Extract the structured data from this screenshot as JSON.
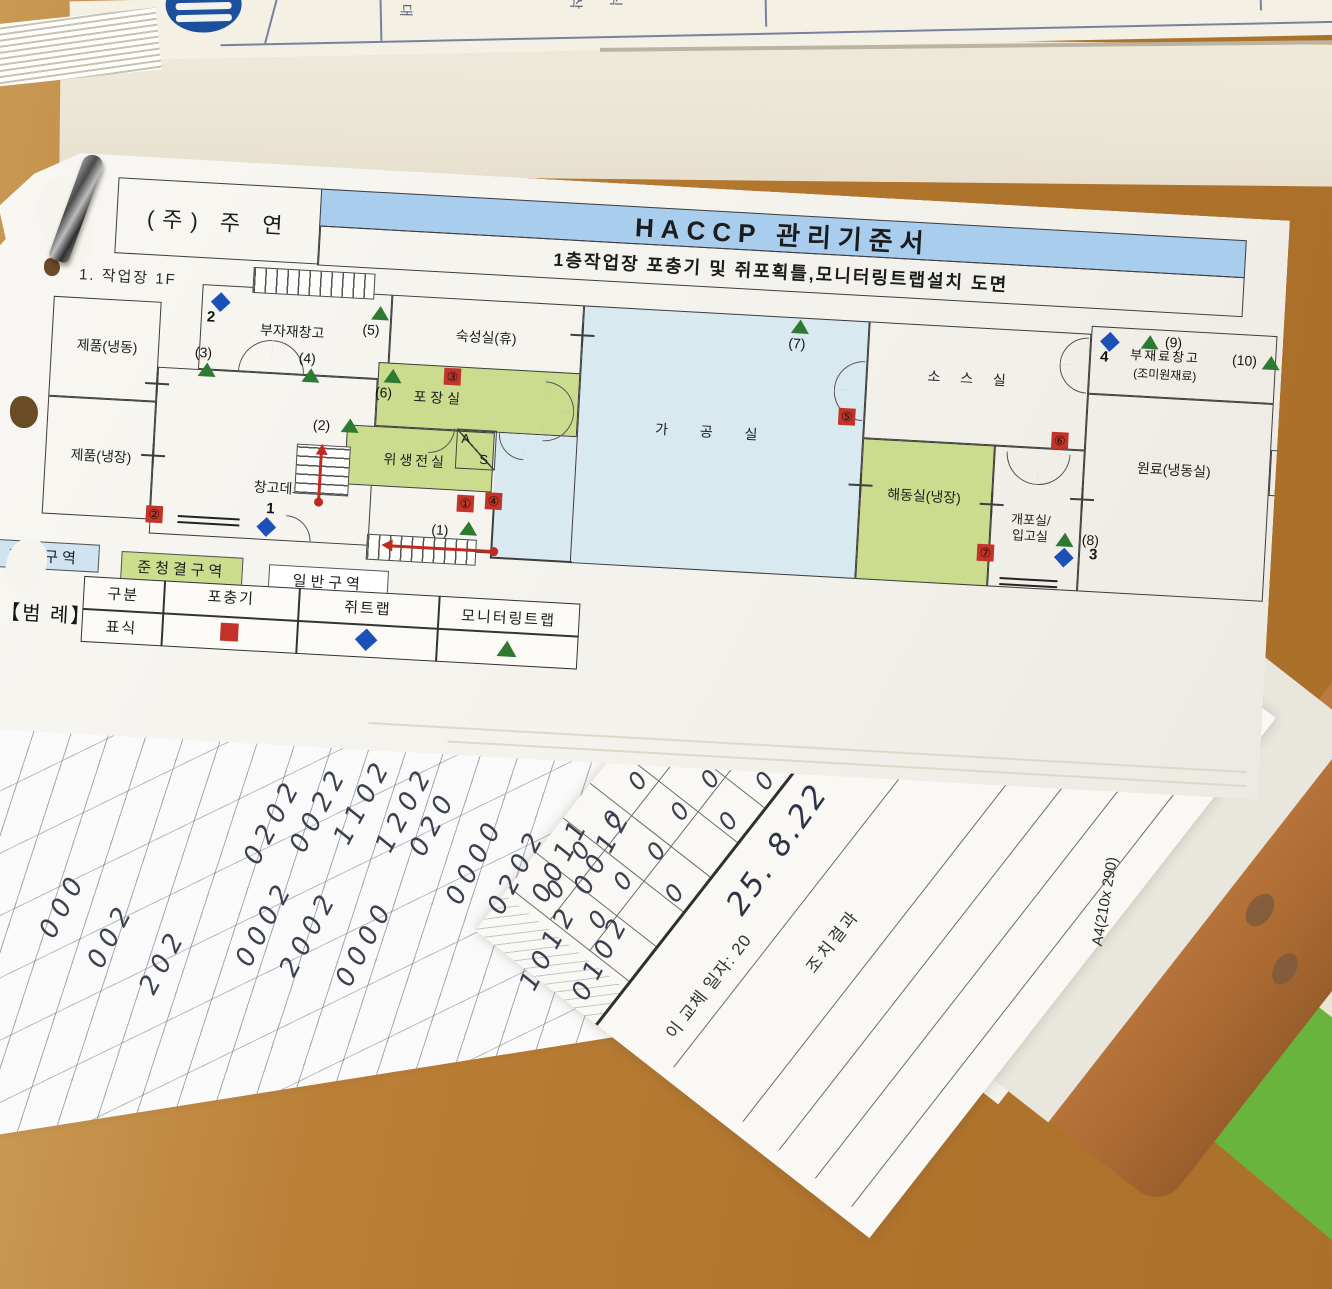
{
  "document": {
    "company": "(주) 주 연",
    "title": "HACCP 관리기준서",
    "subtitle": "1층작업장 포충기 및 쥐포획틀,모니터링트랩설치 도면",
    "page_label": "1. 작업장 1F"
  },
  "colors": {
    "title_band": "#a9cdec",
    "zone_clean": "#cfe4f0",
    "zone_semi_clean": "#ccdd8e",
    "room_green": "#ccdc8f",
    "room_blue": "#d9e9f0",
    "trap_red": "#c2342a",
    "trap_blue": "#1b50b8",
    "trap_green": "#2f7a33",
    "wood": "#b0742c",
    "mat_green": "#69b43c",
    "clipboard_brown": "#ad6c33"
  },
  "top_sheet": {
    "chars": [
      {
        "t": "대",
        "x": 330,
        "y": 6
      },
      {
        "t": "삭",
        "x": 500,
        "y": 2
      },
      {
        "t": "식",
        "x": 540,
        "y": 0
      },
      {
        "t": "구",
        "x": 848,
        "y": 0
      }
    ]
  },
  "plan": {
    "rooms": [
      {
        "id": "jepum-naengdong",
        "label": "제품(냉동)",
        "x": 2,
        "y": 140,
        "w": 108,
        "h": 100,
        "lx": 58,
        "ly": 188
      },
      {
        "id": "jepum-naengjang",
        "label": "제품(냉장)",
        "x": 2,
        "y": 240,
        "w": 108,
        "h": 118,
        "lx": 58,
        "ly": 298
      },
      {
        "id": "bujajae-changgo",
        "label": "부자재창고",
        "x": 150,
        "y": 120,
        "w": 190,
        "h": 85,
        "lx": 242,
        "ly": 163
      },
      {
        "id": "changgo-deck",
        "label": "창고데크",
        "x": 110,
        "y": 205,
        "w": 220,
        "h": 167,
        "lx": 238,
        "ly": 320
      },
      {
        "id": "sukseongsil",
        "label": "숙성실(휴)",
        "x": 340,
        "y": 120,
        "w": 192,
        "h": 85,
        "lx": 436,
        "ly": 158
      },
      {
        "id": "pojangsil",
        "label": "포장실",
        "x": 330,
        "y": 188,
        "w": 202,
        "h": 64,
        "fill": "#ccdc8f",
        "lx": 392,
        "ly": 221,
        "ls": 4
      },
      {
        "id": "wisaeng-jeonsil",
        "label": "위생전실",
        "x": 302,
        "y": 252,
        "w": 148,
        "h": 60,
        "fill": "#ccdc8f",
        "lx": 372,
        "ly": 285,
        "ls": 3
      },
      {
        "id": "gagongsil-patch",
        "label": "",
        "x": 452,
        "y": 252,
        "w": 82,
        "h": 126,
        "fill": "#d9e9f0",
        "nb": true
      },
      {
        "id": "gagongsil",
        "label": "가 공 실",
        "x": 532,
        "y": 120,
        "w": 286,
        "h": 258,
        "fill": "#d9e9f0",
        "lx": 668,
        "ly": 240,
        "ls": 14
      },
      {
        "id": "soseusil",
        "label": "소 스 실",
        "x": 818,
        "y": 120,
        "w": 222,
        "h": 117,
        "lx": 922,
        "ly": 172,
        "ls": 8
      },
      {
        "id": "haedongsil",
        "label": "해동실(냉장)",
        "x": 818,
        "y": 237,
        "w": 132,
        "h": 141,
        "fill": "#ccdc8f",
        "lx": 882,
        "ly": 292
      },
      {
        "id": "gaeposil",
        "label": "개포실/\n입고실",
        "x": 950,
        "y": 237,
        "w": 90,
        "h": 141,
        "lx": 990,
        "ly": 318,
        "fs": 13
      },
      {
        "id": "bujaeryo-changgo",
        "label": "",
        "x": 1040,
        "y": 112,
        "w": 186,
        "h": 68
      },
      {
        "id": "wonryo",
        "label": "원료(냉동실)",
        "x": 1040,
        "y": 180,
        "w": 186,
        "h": 198,
        "lx": 1130,
        "ly": 252
      },
      {
        "id": "chwisujeong",
        "label": "취수정",
        "x": 1226,
        "y": 226,
        "w": 44,
        "h": 46,
        "lx": 1248,
        "ly": 249,
        "vert": true,
        "fs": 11
      }
    ],
    "free_labels": [
      {
        "t": "부재료창고",
        "x": 1080,
        "y": 128,
        "fs": 13,
        "ls": 2
      },
      {
        "t": "(조미원재료)",
        "x": 1084,
        "y": 148,
        "fs": 12
      }
    ],
    "walls": [
      {
        "x": 330,
        "y": 371,
        "len": 124,
        "o": "h"
      },
      {
        "x": 452,
        "y": 376,
        "len": 82,
        "o": "h"
      },
      {
        "x": 452,
        "y": 312,
        "len": 66,
        "o": "v"
      }
    ],
    "stairs": [
      {
        "x": 200,
        "y": 100,
        "w": 122,
        "h": 26,
        "dir": "v"
      },
      {
        "x": 253,
        "y": 274,
        "w": 54,
        "h": 50,
        "dir": "h"
      },
      {
        "x": 328,
        "y": 360,
        "w": 110,
        "h": 26,
        "dir": "v"
      }
    ],
    "docks": [
      {
        "x": 138,
        "y": 352,
        "w": 62
      },
      {
        "x": 962,
        "y": 368,
        "w": 58
      }
    ],
    "doors": [
      {
        "x": 190,
        "y": 172,
        "r": 33,
        "c": "tl"
      },
      {
        "x": 223,
        "y": 172,
        "r": 33,
        "c": "tr"
      },
      {
        "x": 498,
        "y": 198,
        "r": 30,
        "c": "tr"
      },
      {
        "x": 498,
        "y": 228,
        "r": 30,
        "c": "br"
      },
      {
        "x": 786,
        "y": 160,
        "r": 30,
        "c": "tl"
      },
      {
        "x": 786,
        "y": 190,
        "r": 30,
        "c": "bl"
      },
      {
        "x": 384,
        "y": 250,
        "r": 26,
        "c": "br"
      },
      {
        "x": 454,
        "y": 252,
        "r": 26,
        "c": "bl"
      },
      {
        "x": 246,
        "y": 346,
        "r": 26,
        "c": "tr"
      },
      {
        "x": 962,
        "y": 242,
        "r": 32,
        "c": "bl"
      },
      {
        "x": 994,
        "y": 242,
        "r": 32,
        "c": "br"
      },
      {
        "x": 1010,
        "y": 124,
        "r": 28,
        "c": "tl"
      },
      {
        "x": 1010,
        "y": 152,
        "r": 28,
        "c": "bl"
      }
    ],
    "crosses": [
      {
        "x": 110,
        "y": 222
      },
      {
        "x": 110,
        "y": 294
      },
      {
        "x": 532,
        "y": 150
      },
      {
        "x": 818,
        "y": 284
      },
      {
        "x": 950,
        "y": 296
      },
      {
        "x": 1040,
        "y": 286
      }
    ],
    "arrows": [
      {
        "x1": 278,
        "y1": 332,
        "x2": 278,
        "y2": 282
      },
      {
        "x1": 456,
        "y1": 371,
        "x2": 352,
        "y2": 371
      }
    ],
    "insect_traps": [
      {
        "sym": "①",
        "x": 416,
        "y": 316
      },
      {
        "sym": "②",
        "x": 106,
        "y": 344
      },
      {
        "sym": "③",
        "x": 396,
        "y": 190
      },
      {
        "sym": "④",
        "x": 444,
        "y": 312
      },
      {
        "sym": "⑤",
        "x": 792,
        "y": 208
      },
      {
        "sym": "⑥",
        "x": 1006,
        "y": 220
      },
      {
        "sym": "⑦",
        "x": 938,
        "y": 336
      }
    ],
    "rat_traps": [
      {
        "n": "1",
        "x": 220,
        "y": 352,
        "lx": 226,
        "ly": 332
      },
      {
        "n": "2",
        "x": 162,
        "y": 130,
        "lx": 156,
        "ly": 144
      },
      {
        "n": "3",
        "x": 1018,
        "y": 338,
        "lx": 1050,
        "ly": 332
      },
      {
        "n": "4",
        "x": 1052,
        "y": 120,
        "lx": 1050,
        "ly": 134
      }
    ],
    "monitor_traps": [
      {
        "lab": "(1)",
        "x": 420,
        "y": 342,
        "lx": 392,
        "ly": 344
      },
      {
        "lab": "(2)",
        "x": 296,
        "y": 246,
        "lx": 268,
        "ly": 246
      },
      {
        "lab": "(3)",
        "x": 150,
        "y": 198,
        "lx": 146,
        "ly": 180
      },
      {
        "lab": "(4)",
        "x": 254,
        "y": 198,
        "lx": 250,
        "ly": 180
      },
      {
        "lab": "(5)",
        "x": 320,
        "y": 132,
        "lx": 312,
        "ly": 148
      },
      {
        "lab": "(6)",
        "x": 336,
        "y": 194,
        "lx": 328,
        "ly": 210
      },
      {
        "lab": "(7)",
        "x": 740,
        "y": 122,
        "lx": 738,
        "ly": 138
      },
      {
        "lab": "(8)",
        "x": 1016,
        "y": 320,
        "lx": 1042,
        "ly": 318
      },
      {
        "lab": "(9)",
        "x": 1090,
        "y": 118,
        "lx": 1114,
        "ly": 116
      },
      {
        "lab": "(10)",
        "x": 1212,
        "y": 132,
        "lx": 1182,
        "ly": 130
      }
    ],
    "as_box": {
      "x": 412,
      "y": 250,
      "w": 40,
      "h": 40,
      "a": "A",
      "s": "S"
    },
    "zones": [
      {
        "label": "청결구역",
        "x": -48,
        "y": 386,
        "w": 110,
        "h": 28,
        "fill": "#cfe4f0"
      },
      {
        "label": "준청결구역",
        "x": 84,
        "y": 391,
        "w": 122,
        "h": 28,
        "fill": "#ccdd8e"
      },
      {
        "label": "일반구역",
        "x": 232,
        "y": 396,
        "w": 120,
        "h": 28,
        "fill": "#ffffff"
      }
    ],
    "legend_title": "【범 례】",
    "legend": {
      "box": {
        "x": 48,
        "y": 418,
        "w": 497,
        "h": 66
      },
      "vlines": [
        128,
        263,
        403
      ],
      "hline_y": 450,
      "headers": [
        {
          "t": "구분",
          "x": 88,
          "y": 434
        },
        {
          "t": "포충기",
          "x": 196,
          "y": 431
        },
        {
          "t": "쥐트랩",
          "x": 333,
          "y": 434
        },
        {
          "t": "모니터링트랩",
          "x": 474,
          "y": 436
        }
      ],
      "row_label": {
        "t": "표식",
        "x": 88,
        "y": 467
      },
      "symbols": [
        {
          "k": "sq",
          "x": 196,
          "y": 466
        },
        {
          "k": "d",
          "x": 333,
          "y": 466
        },
        {
          "k": "t",
          "x": 474,
          "y": 467
        }
      ]
    }
  },
  "bottom": {
    "digits": [
      {
        "t": "000",
        "x": 28,
        "y": 890
      },
      {
        "t": "002",
        "x": 76,
        "y": 920
      },
      {
        "t": "202",
        "x": 128,
        "y": 946
      },
      {
        "t": "0202",
        "x": 226,
        "y": 806
      },
      {
        "t": "0022",
        "x": 272,
        "y": 794
      },
      {
        "t": "1102",
        "x": 316,
        "y": 786
      },
      {
        "t": "1202",
        "x": 358,
        "y": 794
      },
      {
        "t": "020",
        "x": 398,
        "y": 808
      },
      {
        "t": "0002",
        "x": 218,
        "y": 908
      },
      {
        "t": "2002",
        "x": 262,
        "y": 918
      },
      {
        "t": "0000",
        "x": 318,
        "y": 928
      },
      {
        "t": "0000",
        "x": 428,
        "y": 846
      },
      {
        "t": "0202",
        "x": 470,
        "y": 856
      },
      {
        "t": "0011",
        "x": 514,
        "y": 844
      },
      {
        "t": "0012",
        "x": 556,
        "y": 836
      },
      {
        "t": "1012",
        "x": 502,
        "y": 932
      },
      {
        "t": "0102",
        "x": 554,
        "y": 942
      }
    ],
    "form": {
      "replace_label": "이 교체 일자: 20",
      "replace_date": "25. 8.22",
      "result_header": "조치결과",
      "paper_size": "A4(210x 290)",
      "zeros": [
        {
          "x": 50,
          "y": -128
        },
        {
          "x": 96,
          "y": -132
        },
        {
          "x": 140,
          "y": -126
        },
        {
          "x": 186,
          "y": -130
        },
        {
          "x": 230,
          "y": -124
        },
        {
          "x": 274,
          "y": -128
        },
        {
          "x": 52,
          "y": -76
        },
        {
          "x": 98,
          "y": -80
        },
        {
          "x": 142,
          "y": -72
        },
        {
          "x": 188,
          "y": -78
        },
        {
          "x": 232,
          "y": -74
        },
        {
          "x": 276,
          "y": -70
        },
        {
          "x": 120,
          "y": -32
        },
        {
          "x": 210,
          "y": -34
        },
        {
          "x": 264,
          "y": -30
        }
      ],
      "cell_vx": [
        30,
        74,
        118,
        162,
        206,
        250,
        294
      ],
      "cell_hy": [
        -100,
        -50
      ],
      "row_lines": [
        88,
        176,
        222,
        268,
        314
      ]
    }
  }
}
